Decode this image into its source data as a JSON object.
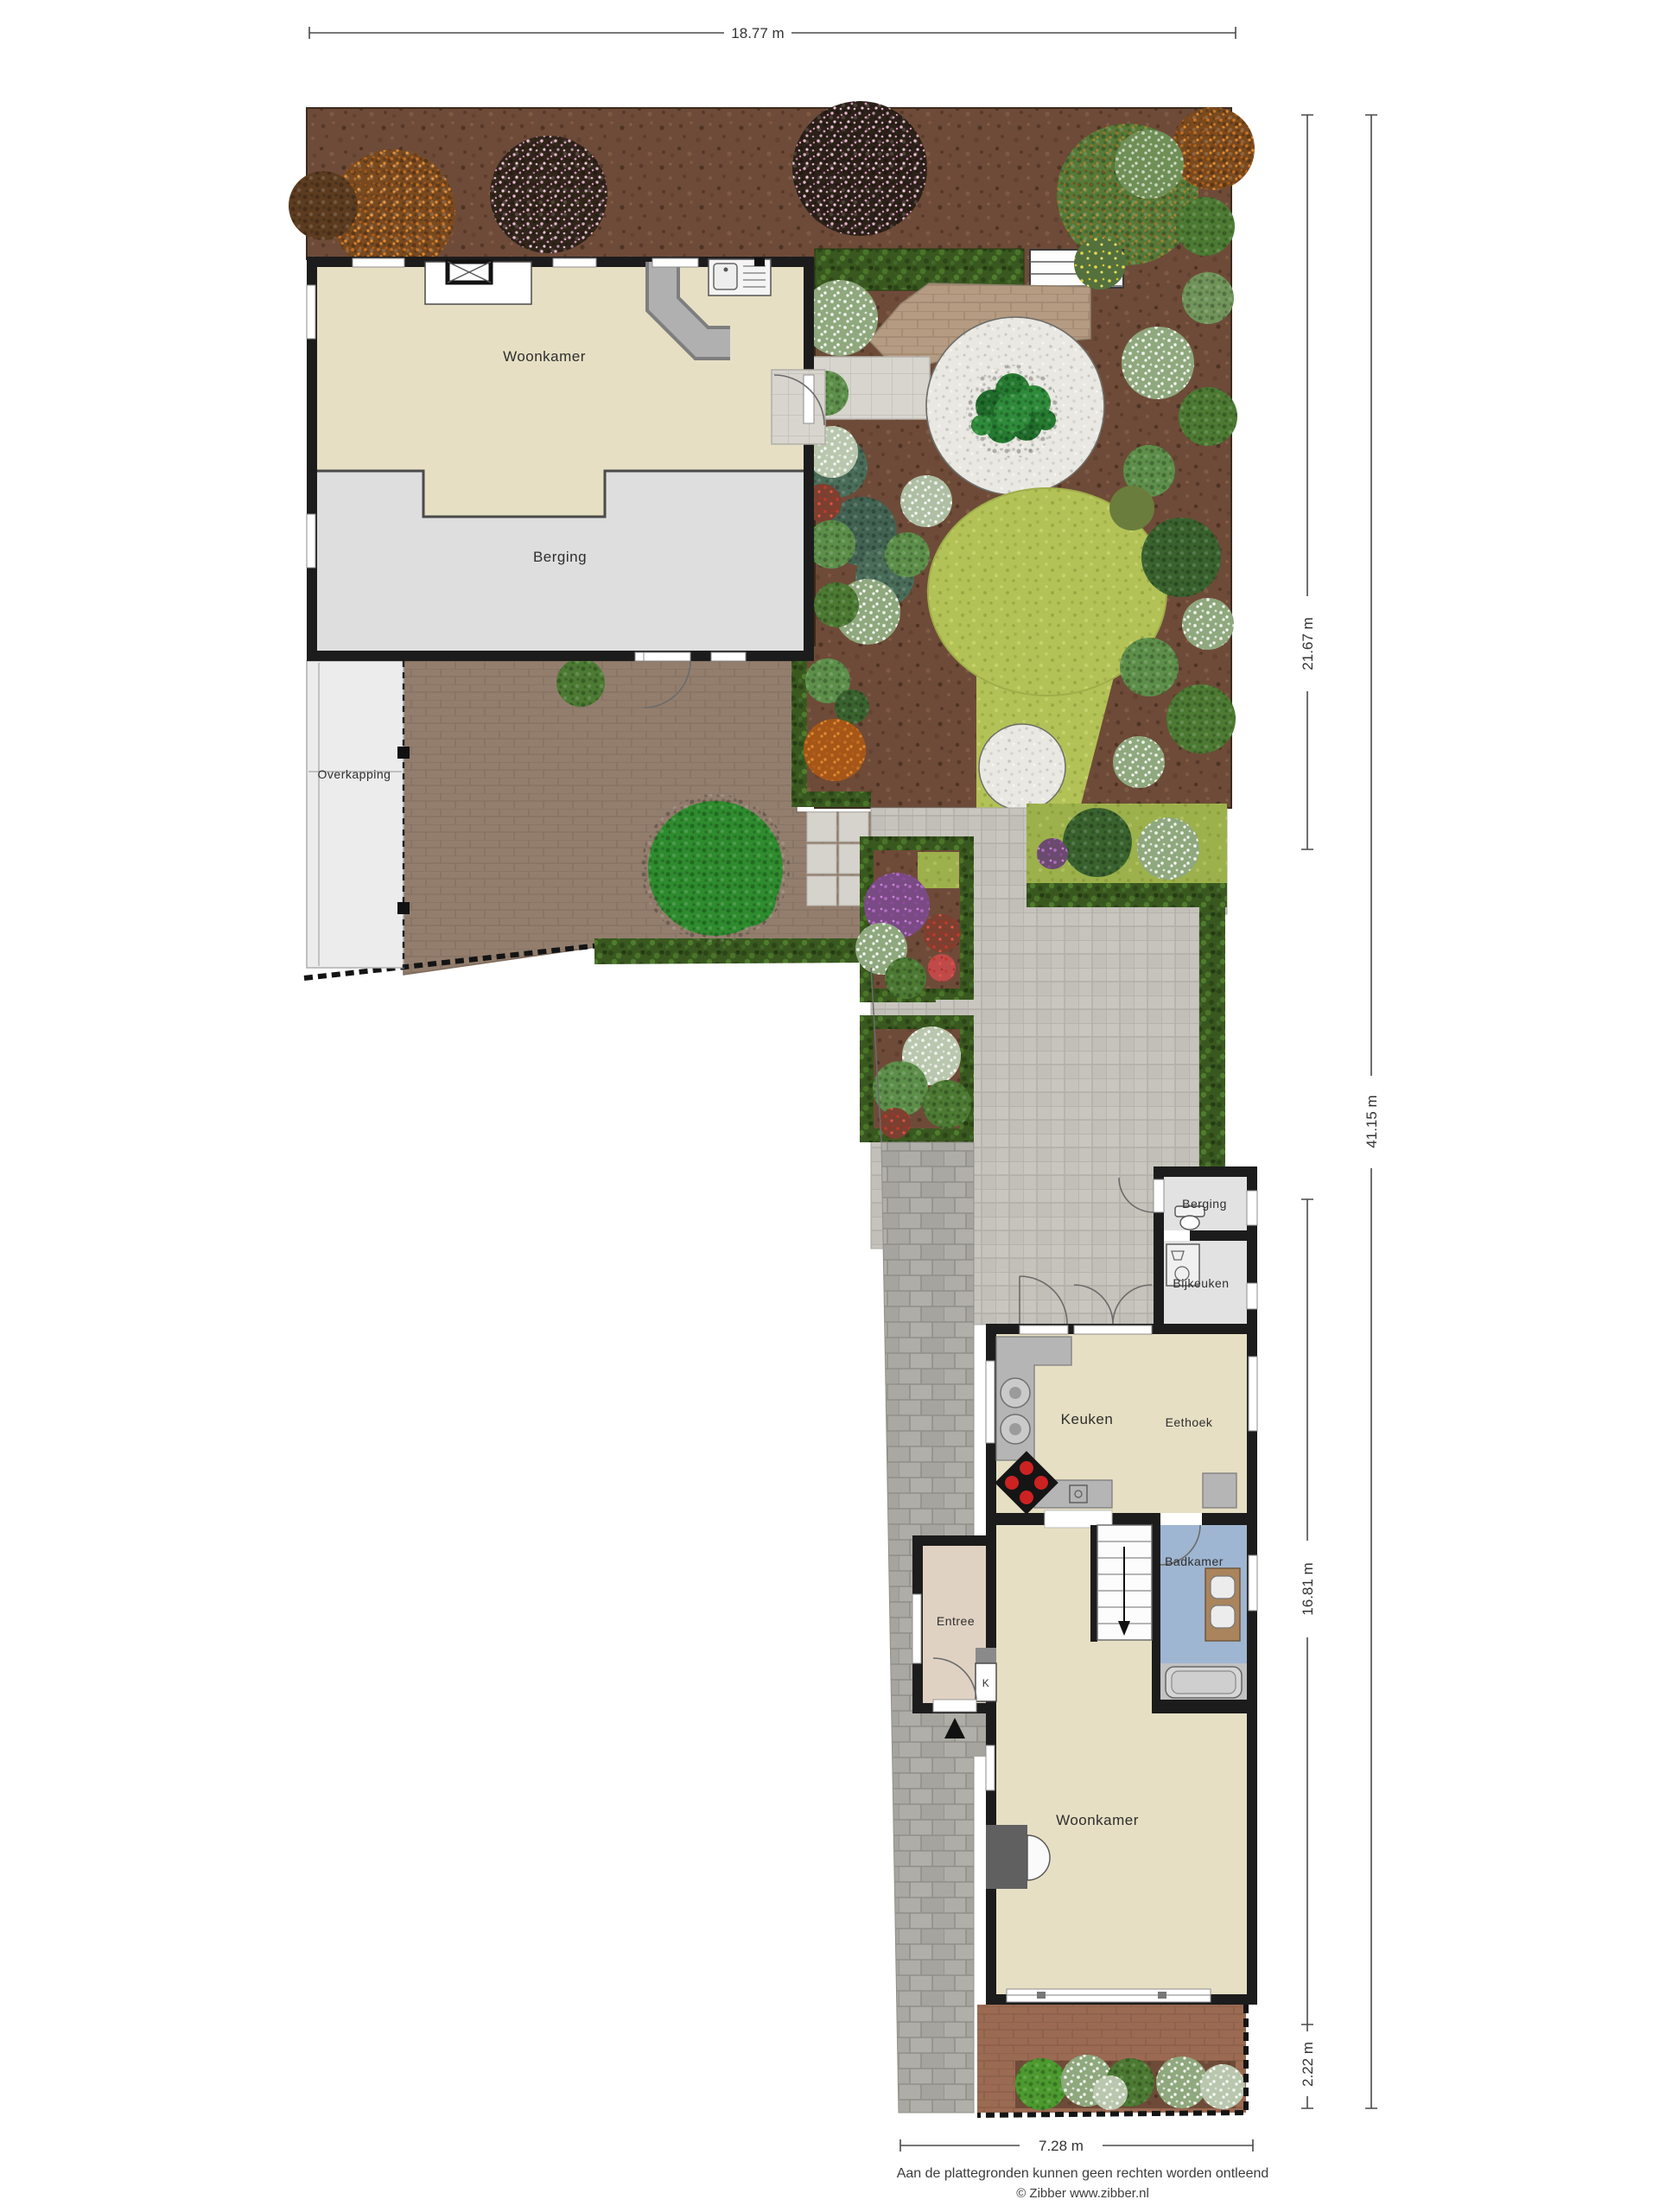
{
  "rooms": {
    "woonkamer_top": "Woonkamer",
    "berging_top": "Berging",
    "overkapping": "Overkapping",
    "berging_annex": "Berging",
    "bijkeuken": "Bijkeuken",
    "keuken": "Keuken",
    "eethoek": "Eethoek",
    "badkamer": "Badkamer",
    "entree": "Entree",
    "closet": "K",
    "woonkamer_lower": "Woonkamer"
  },
  "dimensions": {
    "top_width": "18.77 m",
    "right_upper": "21.67 m",
    "right_total": "41.15 m",
    "right_house": "16.81 m",
    "right_front": "2.22 m",
    "bottom_width": "7.28 m"
  },
  "footer": {
    "disclaimer": "Aan de plattegronden kunnen geen rechten worden ontleend",
    "credit": "© Zibber www.zibber.nl"
  },
  "legend_colors": {
    "soil": "#6E4B38",
    "lawn": "#B4C45C",
    "hedge": "#3A5F28",
    "gravel": "#EAE9E3",
    "path_pavers": "#C6C3BC",
    "patio_brick": "#95806F",
    "terrace_brick": "#B59C83",
    "front_brick": "#9B6A52",
    "floor_beige": "#E6DFC3",
    "floor_gray": "#DEDEDE",
    "bathroom_blue": "#9FB6D2",
    "entree_floor": "#E0D2C2",
    "wall": "#1C1C1C",
    "driveway": "#ABAAA5"
  }
}
